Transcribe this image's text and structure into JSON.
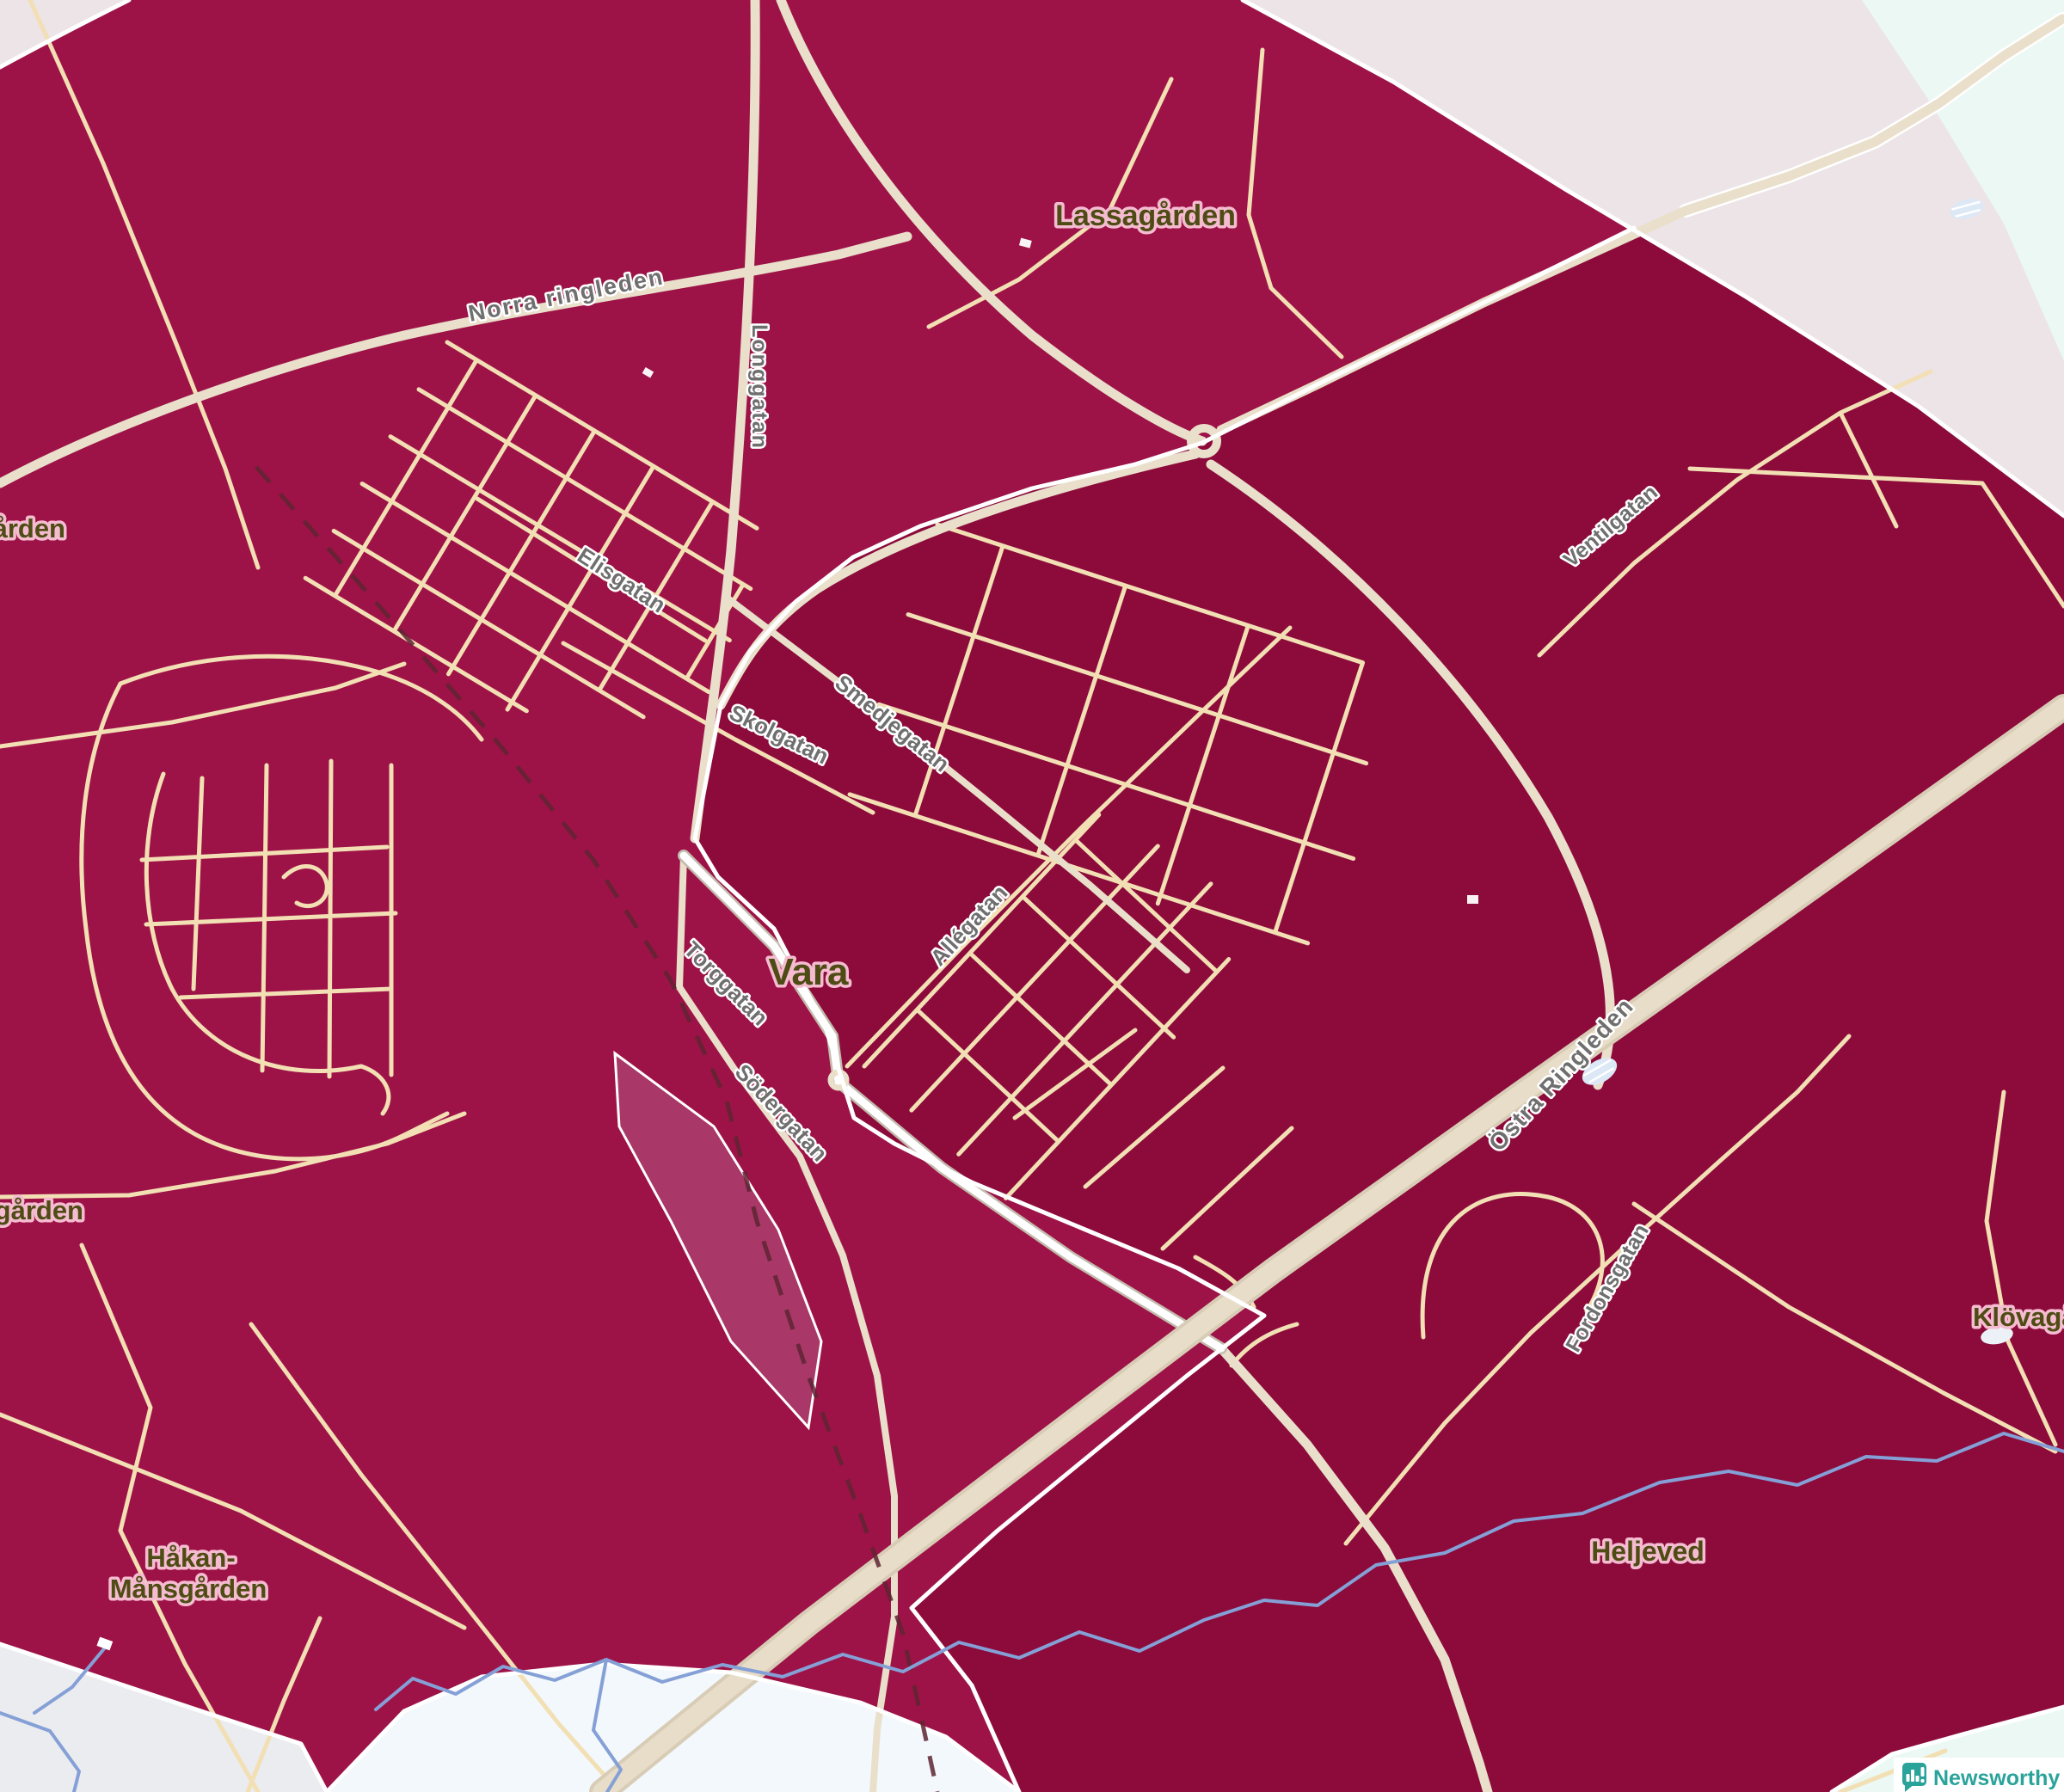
{
  "map": {
    "places": {
      "lassagarden": "Lassagården",
      "vara": "Vara",
      "hakan_line1": "Håkan-",
      "hakan_line2": "Månsgården",
      "heljeved": "Heljeved",
      "klovagarden_clipped": "Klövagå",
      "arden_clipped": "ården",
      "garden_clipped": "gården"
    },
    "streets": {
      "norra_ringleden": "Norra ringleden",
      "langgatan": "Longgatan",
      "elisgatan": "Elisgatan",
      "skolgatan": "Skolgatan",
      "smedjegatan": "Smedjegatan",
      "allegatan": "Allégatan",
      "torggatan": "Torggatan",
      "sodergatan": "Södergatan",
      "ostra_ringleden": "Östra Ringleden",
      "ventilgatan": "Ventilgatan",
      "fordonsgatan": "Fordonsgatan"
    }
  },
  "attribution": {
    "brand": "Newsworthy"
  },
  "colors": {
    "region_high": "#8C0B3B",
    "region_mid": "#9E1347",
    "region_light": "#A93767",
    "outside_pink": "#ECE4E7",
    "outside_mint": "#EBF8F3",
    "outside_azure": "#F2F8FB",
    "outside_gray": "#EBECEF",
    "road": "#F2DFB4",
    "road_major": "#E9DFCA",
    "road_casing": "#C3BBAD",
    "motorway": "#E8DDC8",
    "motorway_edge": "#D8CCB6",
    "railway": "#5E2433",
    "water": "#85A0D6",
    "marsh": "#DCE8F6",
    "boundary": "#FFFFFF",
    "street_label": "#6F6F6F",
    "place_label": "#4E4C14",
    "brand_teal": "#2AA39A"
  }
}
